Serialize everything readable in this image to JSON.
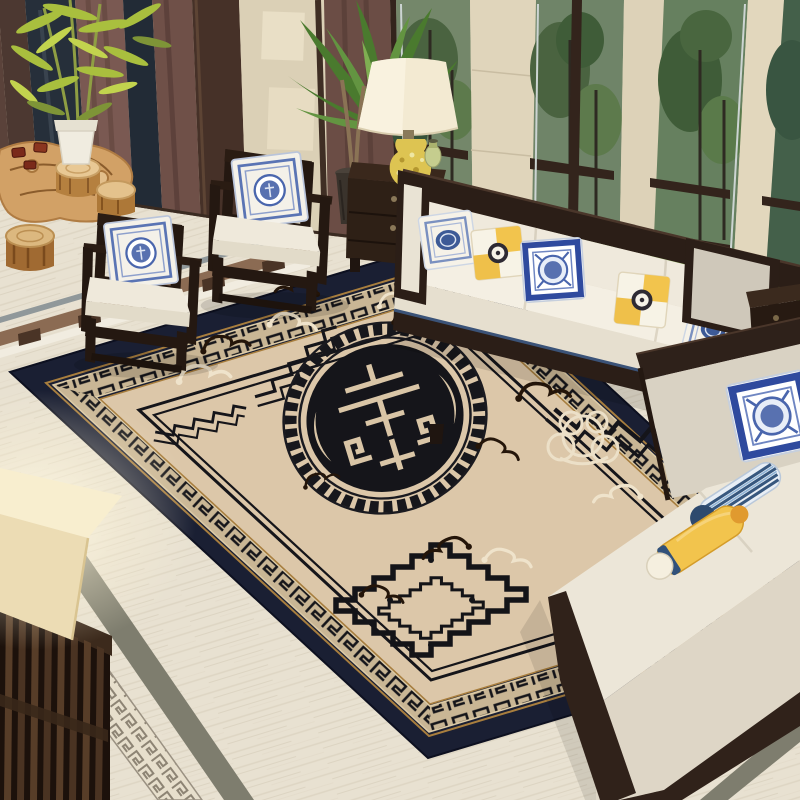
{
  "meta": {
    "image_type": "photorealistic interior scene (rug product photo)",
    "description": "Chinese-style living room: large beige traditional rug with black longevity medallion and Greek-key borders, dark wood furniture with white cushions, blue-white porcelain pillows, windows with greenery",
    "visible_text": "none"
  },
  "palette": {
    "wall_base": "#d8cdb4",
    "pier_light": "#e0d5bb",
    "floor_base": "#e8e1d1",
    "floor_streak": "#d6ccb8",
    "rug_navy": "#1a1f33",
    "rug_band_beige": "#c9b695",
    "rug_field": "#dcc7a9",
    "rug_black": "#15151a",
    "accent_gold": "#a87e3e",
    "wood_dark": "#2b1e17",
    "wood_mid": "#463128",
    "cushion_white": "#efe9dc",
    "sectional_beige": "#ece6d8",
    "curtain_brown": "#7a5952",
    "grass_green": "#83ad52",
    "tree_green": "#4a6340",
    "foliage_green": "#4a7a2e",
    "bamboo_green": "#a9bf3e",
    "lampshade_cream": "#f3ead2",
    "ceramic_yellow": "#ddc452",
    "pillow_blue": "#3d5a96",
    "pillow_navy_border": "#2f4a9e",
    "pillow_yellow": "#f2c44d",
    "bolster_navy": "#2e4a6e",
    "root_table_tan": "#d2a166",
    "stool_tan": "#b5803f",
    "cream_motif": "#ece0c8",
    "dark_motif": "#241509"
  },
  "scene": {
    "objects": [
      {
        "name": "area-rug",
        "desc": "large beige rug, navy outer border, black Greek-key band, central round black longevity medallion, cloud motifs"
      },
      {
        "name": "rug-medallion",
        "desc": "black circular shou symbol ringed by Greek-key fret"
      },
      {
        "name": "sofa",
        "desc": "three-seat white sofa with dark wood frame and five pillows"
      },
      {
        "name": "armchairs",
        "desc": "two dark wood cube armchairs with white cushions and blue-white pillows"
      },
      {
        "name": "sectional-bench",
        "desc": "beige upholstered sectional with wood trim, porcelain pillow and bolsters"
      },
      {
        "name": "table-lamp",
        "desc": "cream bell shade on yellow floral ceramic base"
      },
      {
        "name": "nightstand",
        "desc": "dark wood drawer cabinet"
      },
      {
        "name": "side-table",
        "desc": "small dark wood drawer table at right"
      },
      {
        "name": "root-tea-table",
        "desc": "carved natural root table with red tea cups"
      },
      {
        "name": "log-stools",
        "desc": "three rustic log stools"
      },
      {
        "name": "bamboo-plant",
        "desc": "bamboo in white planter, top left"
      },
      {
        "name": "palm-plant",
        "desc": "large leafy plant in dark pot"
      },
      {
        "name": "windows",
        "desc": "dark-framed windows showing trees and lawn"
      },
      {
        "name": "curtains",
        "desc": "brown drapes between windows"
      },
      {
        "name": "slat-console",
        "desc": "dark slatted wood piece, bottom-left foreground"
      },
      {
        "name": "floor-lampshade",
        "desc": "glowing cream lampshade, bottom-left"
      },
      {
        "name": "marble-floor",
        "desc": "light travertine floor with Greek-key mosaic border strips"
      }
    ]
  }
}
